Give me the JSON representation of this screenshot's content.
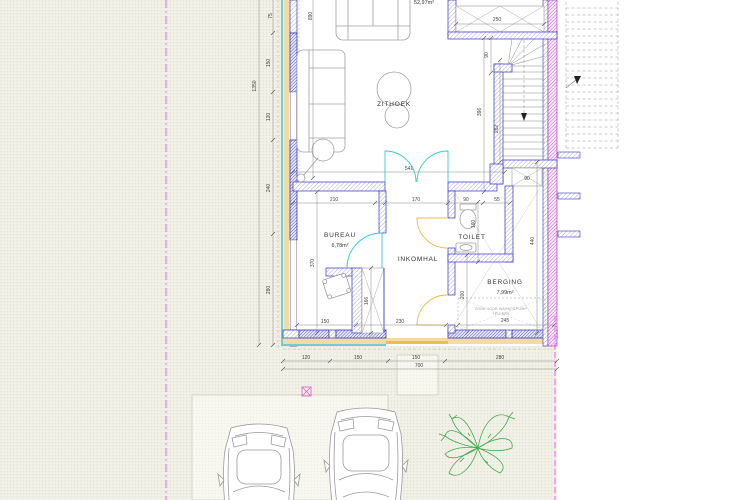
{
  "rooms": {
    "zithoek": {
      "name": "ZITHOEK"
    },
    "bureau": {
      "name": "BUREAU",
      "area": "6,78m²"
    },
    "inkomhal": {
      "name": "INKOMHAL"
    },
    "toilet": {
      "name": "TOILET"
    },
    "berging": {
      "name": "BERGING",
      "area": "7,99m²"
    }
  },
  "labels": {
    "top_area": "52,97m²",
    "zone_note_line1": "ZONE VOOR WARMTEPOMP",
    "zone_note_line2": "TELLERS"
  },
  "dims": {
    "left_total": "1350",
    "left_a": "75",
    "left_b": "150",
    "left_c": "120",
    "left_d": "240",
    "left_e": "280",
    "living_height": "890",
    "living_width": "541",
    "stair_top": "250",
    "stair_winder": "90",
    "stair_total": "396",
    "stair_flight": "262",
    "stair_landing": "90",
    "hall_a": "210",
    "hall_b": "170",
    "hall_c": "90",
    "hall_d": "55",
    "toilet_h": "160",
    "berging_h": "440",
    "berging_w": "245",
    "hall_h": "200",
    "shaft_w": "166",
    "bureau_h": "370",
    "bureau_a": "150",
    "bureau_b": "230",
    "bottom_a": "120",
    "bottom_b": "150",
    "bottom_c": "150",
    "bottom_d": "280",
    "bottom_total": "700"
  },
  "colors": {
    "wall_blue": "#3232c8",
    "party_wall_purple": "#c653d6",
    "insulation_tan": "#f2dba4",
    "cladding_cyan": "#6ecfcf",
    "interior_door_cyan": "#35c8d2",
    "entry_door_yellow": "#f0b840",
    "property_line_magenta": "#ff5cff",
    "plant_green": "#3fae4f",
    "dim_grey": "#444444",
    "background_beige": "#f1f1e8"
  }
}
